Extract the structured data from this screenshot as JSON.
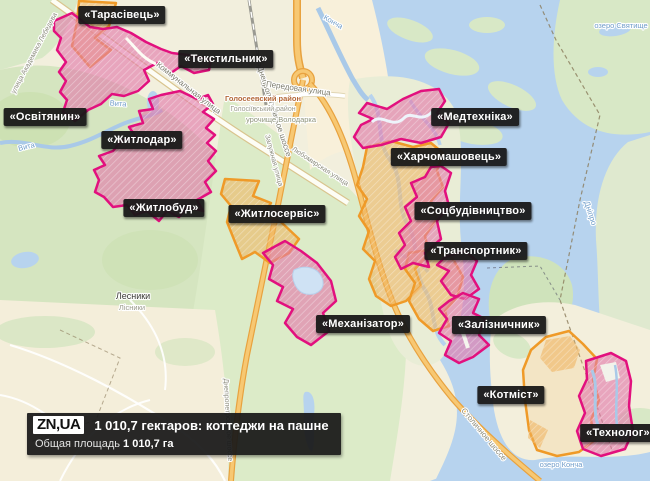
{
  "map": {
    "area_labels": [
      {
        "name": "tarasivets",
        "text": "«Тарасівець»"
      },
      {
        "name": "tekstylnyk",
        "text": "«Текстильник»"
      },
      {
        "name": "osvityanyn",
        "text": "«Освітянин»"
      },
      {
        "name": "zhytlodar",
        "text": "«Житлодар»"
      },
      {
        "name": "zhytlobud",
        "text": "«Житлобуд»"
      },
      {
        "name": "zhytloservis",
        "text": "«Житлосервіс»"
      },
      {
        "name": "mekhanizator",
        "text": "«Механізатор»"
      },
      {
        "name": "medtekhnika",
        "text": "«Медтехніка»"
      },
      {
        "name": "kharchomashovets",
        "text": "«Харчомашовець»"
      },
      {
        "name": "sotsbudivnytstvo",
        "text": "«Соцбудівництво»"
      },
      {
        "name": "transportnyk",
        "text": "«Транспортник»"
      },
      {
        "name": "zaliznychnyk",
        "text": "«Залізничник»"
      },
      {
        "name": "kotmist",
        "text": "«Котміст»"
      },
      {
        "name": "tekhnolog",
        "text": "«Технолог»"
      }
    ],
    "street_labels": [
      {
        "text": "Коммунальная улица"
      },
      {
        "text": "Днепропетровское шоссе"
      },
      {
        "text": "Передовая улица"
      },
      {
        "text": "Залужная улица"
      },
      {
        "text": "Любомирская улица"
      },
      {
        "text": "улица Академика Лебедева"
      },
      {
        "text": "Столичное шоссе"
      },
      {
        "text": "Днепропетровское шоссе"
      }
    ],
    "district_labels": [
      {
        "text": "Голосеевский район"
      },
      {
        "text": "Голосіївський район"
      },
      {
        "text": "урочище Володарка"
      }
    ],
    "water_labels": [
      {
        "text": "Вита"
      },
      {
        "text": "Вита"
      },
      {
        "text": "Конча"
      },
      {
        "text": "Дніпро"
      },
      {
        "text": "озеро Конча"
      },
      {
        "text": "озеро Святище"
      }
    ],
    "settlement_labels": [
      {
        "text": "Лесники"
      },
      {
        "text": "Лісники"
      }
    ]
  },
  "caption": {
    "logo": "ZN,UA",
    "title": "1 010,7 гектаров: коттеджи на пашне",
    "subtitle_label": "Общая площадь",
    "subtitle_value": "1 010,7 га"
  },
  "colors": {
    "parcel_pink_outline": "#e2107e",
    "parcel_orange_outline": "#ef9a28",
    "water": "#b7d3ee",
    "label_background": "#181818"
  }
}
